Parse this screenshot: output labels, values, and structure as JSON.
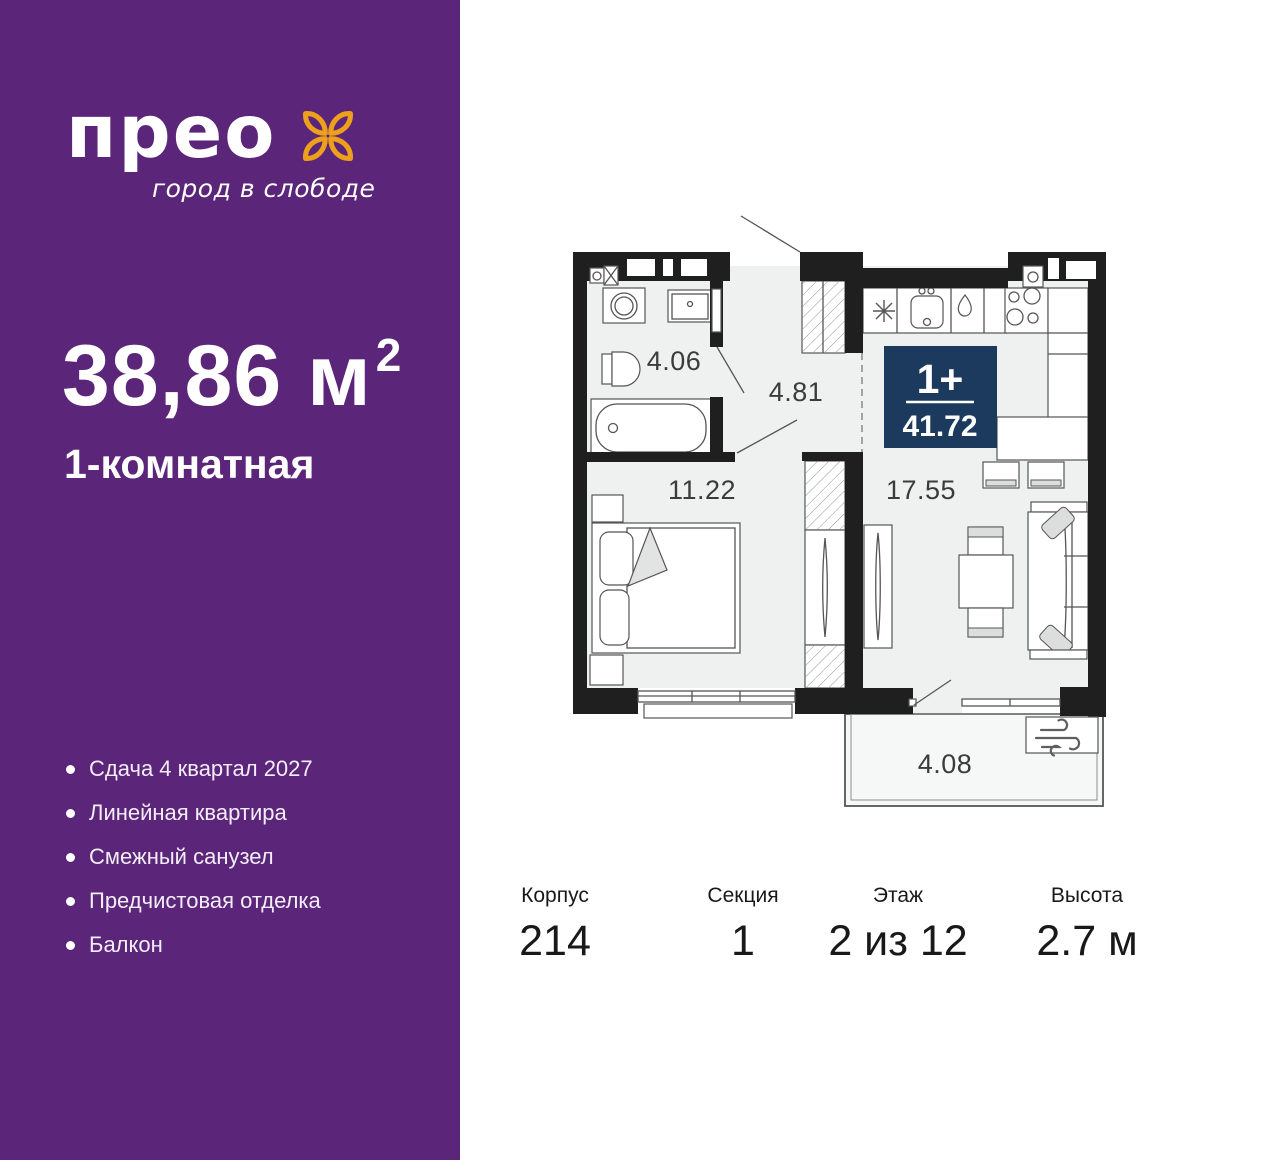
{
  "brand": {
    "logo": "прео",
    "tagline": "город в слободе",
    "flower_icon": "four-petal-flower",
    "accent_orange": "#EDA01C"
  },
  "apartment": {
    "area": "38,86 м",
    "area_superscript": "2",
    "type": "1-комнатная",
    "features": [
      "Сдача 4 квартал 2027",
      "Линейная квартира",
      "Смежный санузел",
      "Предчистовая отделка",
      "Балкон"
    ]
  },
  "plan": {
    "badge": {
      "layout": "1+",
      "total_area": "41.72"
    },
    "room_areas": {
      "bathroom": "4.06",
      "hallway": "4.81",
      "bedroom": "11.22",
      "kitchen_living": "17.55",
      "balcony": "4.08"
    }
  },
  "specs": [
    {
      "label": "Корпус",
      "value": "214"
    },
    {
      "label": "Секция",
      "value": "1"
    },
    {
      "label": "Этаж",
      "value": "2 из 12"
    },
    {
      "label": "Высота",
      "value": "2.7 м"
    }
  ],
  "colors": {
    "sidebar_purple": "#5B2579",
    "accent_orange": "#EDA01C",
    "badge_navy": "#1C3A5E",
    "wall_black": "#1F1F1F",
    "floor_gray": "#EFF1F0"
  }
}
